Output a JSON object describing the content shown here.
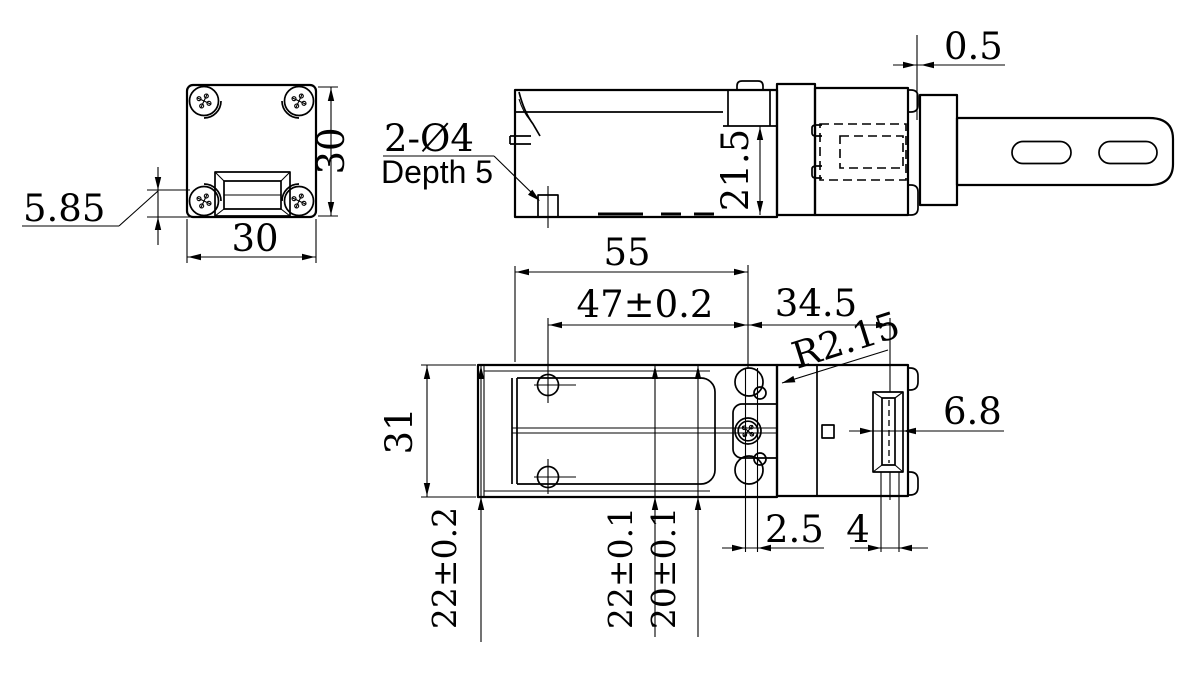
{
  "drawing": {
    "background_color": "#ffffff",
    "line_color": "#000000",
    "front_view": {
      "width": "30",
      "height": "30",
      "bezel_height": "5.85"
    },
    "side_view": {
      "hole_note": "2-Ø4",
      "hole_depth": "Depth 5",
      "body_height": "21.5",
      "lever_offset": "0.5"
    },
    "top_view": {
      "body_length": "55",
      "hole_pitch": "47±0.2",
      "head_length": "34.5",
      "corner_radius": "R2.15",
      "body_width": "31",
      "plunger_width": "6.8",
      "slot_offset": "2.5",
      "slot_width": "4",
      "mount_pitch_left": "22±0.2",
      "mount_pitch_mid": "22±0.1",
      "mount_pitch_right": "20±0.1"
    }
  }
}
